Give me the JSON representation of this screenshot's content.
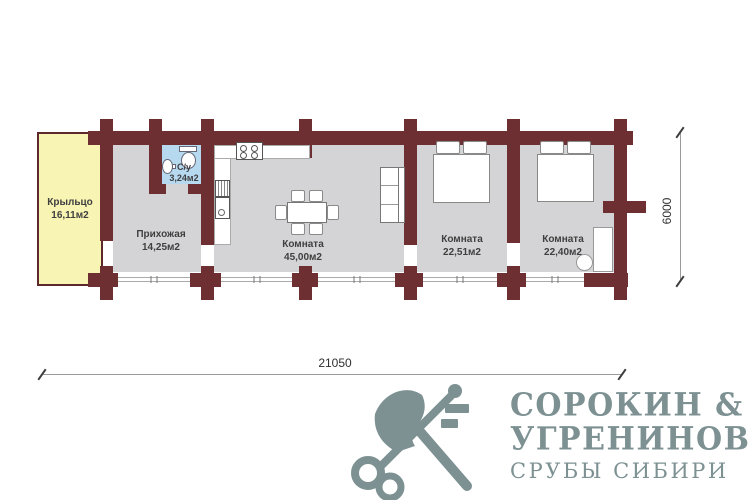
{
  "plan": {
    "rooms": [
      {
        "id": "porch",
        "name": "Крыльцо",
        "area": "16,11м2"
      },
      {
        "id": "hallway",
        "name": "Прихожая",
        "area": "14,25м2"
      },
      {
        "id": "bathroom",
        "name": "С/у",
        "area": "3,24м2"
      },
      {
        "id": "living",
        "name": "Комната",
        "area": "45,00м2"
      },
      {
        "id": "bedroom1",
        "name": "Комната",
        "area": "22,51м2"
      },
      {
        "id": "bedroom2",
        "name": "Комната",
        "area": "22,40м2"
      }
    ],
    "dimensions": {
      "width_label": "21050",
      "height_label": "6000"
    },
    "furniture": [
      "stove",
      "kitchen-sink",
      "dining-table",
      "six-chairs",
      "sofa",
      "double-bed",
      "double-bed",
      "wardrobe",
      "water-heater",
      "toilet",
      "washbasin"
    ],
    "colors": {
      "wall": "#6e2f33",
      "floor": "#d4d4d6",
      "porch": "#f7f4b4",
      "bathroom": "#b6d9ef",
      "logo": "#7d9193",
      "label": "#3f3f3f"
    }
  },
  "logo": {
    "icon": "axe-and-key-icon",
    "line1": "СОРОКИН &",
    "line2": "УГРЕНИНОВ",
    "line3": "СРУБЫ СИБИРИ"
  }
}
